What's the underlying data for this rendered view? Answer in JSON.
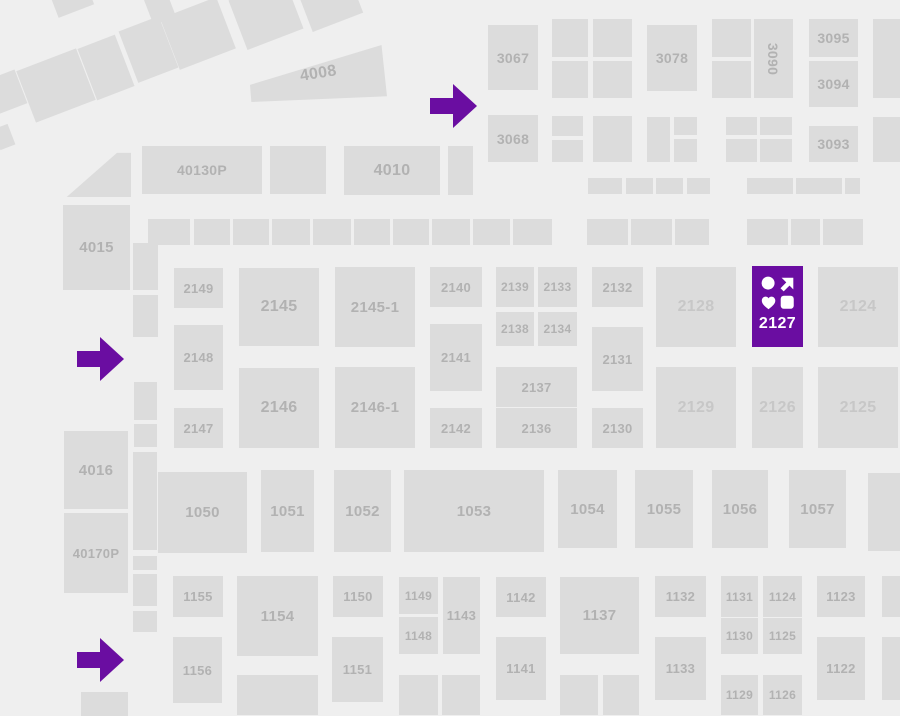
{
  "map_title": "expo-floor-plan",
  "colors": {
    "background": "#efefef",
    "booth_fill": "#dcdcdc",
    "booth_label": "#b2b2b2",
    "booth_label_light": "#c7c7c7",
    "highlight": "#6a0da1",
    "highlight_label": "#ffffff"
  },
  "highlight": {
    "id": "2127",
    "label": "2127",
    "icons": [
      "circle-icon",
      "arrow-up-right-icon",
      "heart-icon",
      "rounded-square-icon"
    ]
  },
  "arrows": [
    {
      "direction": "right"
    },
    {
      "direction": "right"
    },
    {
      "direction": "right"
    }
  ],
  "booths": [
    {
      "id": "4008",
      "label": "4008"
    },
    {
      "id": "40130P",
      "label": "40130P"
    },
    {
      "id": "4010",
      "label": "4010"
    },
    {
      "id": "3067",
      "label": "3067"
    },
    {
      "id": "3068",
      "label": "3068"
    },
    {
      "id": "3078",
      "label": "3078"
    },
    {
      "id": "3090",
      "label": "3090"
    },
    {
      "id": "3095",
      "label": "3095"
    },
    {
      "id": "3094",
      "label": "3094"
    },
    {
      "id": "3093",
      "label": "3093"
    },
    {
      "id": "4015",
      "label": "4015"
    },
    {
      "id": "2149",
      "label": "2149"
    },
    {
      "id": "2145",
      "label": "2145"
    },
    {
      "id": "2145-1",
      "label": "2145-1"
    },
    {
      "id": "2140",
      "label": "2140"
    },
    {
      "id": "2139",
      "label": "2139"
    },
    {
      "id": "2133",
      "label": "2133"
    },
    {
      "id": "2132",
      "label": "2132"
    },
    {
      "id": "2128",
      "label": "2128"
    },
    {
      "id": "2124",
      "label": "2124"
    },
    {
      "id": "2148",
      "label": "2148"
    },
    {
      "id": "2138",
      "label": "2138"
    },
    {
      "id": "2134",
      "label": "2134"
    },
    {
      "id": "2141",
      "label": "2141"
    },
    {
      "id": "2131",
      "label": "2131"
    },
    {
      "id": "2137",
      "label": "2137"
    },
    {
      "id": "2147",
      "label": "2147"
    },
    {
      "id": "2146",
      "label": "2146"
    },
    {
      "id": "2146-1",
      "label": "2146-1"
    },
    {
      "id": "2142",
      "label": "2142"
    },
    {
      "id": "2136",
      "label": "2136"
    },
    {
      "id": "2130",
      "label": "2130"
    },
    {
      "id": "2129",
      "label": "2129"
    },
    {
      "id": "2126",
      "label": "2126"
    },
    {
      "id": "2125",
      "label": "2125"
    },
    {
      "id": "4016",
      "label": "4016"
    },
    {
      "id": "40170P",
      "label": "40170P"
    },
    {
      "id": "1050",
      "label": "1050"
    },
    {
      "id": "1051",
      "label": "1051"
    },
    {
      "id": "1052",
      "label": "1052"
    },
    {
      "id": "1053",
      "label": "1053"
    },
    {
      "id": "1054",
      "label": "1054"
    },
    {
      "id": "1055",
      "label": "1055"
    },
    {
      "id": "1056",
      "label": "1056"
    },
    {
      "id": "1057",
      "label": "1057"
    },
    {
      "id": "1155",
      "label": "1155"
    },
    {
      "id": "1154",
      "label": "1154"
    },
    {
      "id": "1150",
      "label": "1150"
    },
    {
      "id": "1149",
      "label": "1149"
    },
    {
      "id": "1143",
      "label": "1143"
    },
    {
      "id": "1148",
      "label": "1148"
    },
    {
      "id": "1142",
      "label": "1142"
    },
    {
      "id": "1137",
      "label": "1137"
    },
    {
      "id": "1141",
      "label": "1141"
    },
    {
      "id": "1156",
      "label": "1156"
    },
    {
      "id": "1151",
      "label": "1151"
    },
    {
      "id": "1132",
      "label": "1132"
    },
    {
      "id": "1131",
      "label": "1131"
    },
    {
      "id": "1124",
      "label": "1124"
    },
    {
      "id": "1123",
      "label": "1123"
    },
    {
      "id": "1130",
      "label": "1130"
    },
    {
      "id": "1125",
      "label": "1125"
    },
    {
      "id": "1133",
      "label": "1133"
    },
    {
      "id": "1122",
      "label": "1122"
    },
    {
      "id": "1129",
      "label": "1129"
    },
    {
      "id": "1126",
      "label": "1126"
    }
  ]
}
